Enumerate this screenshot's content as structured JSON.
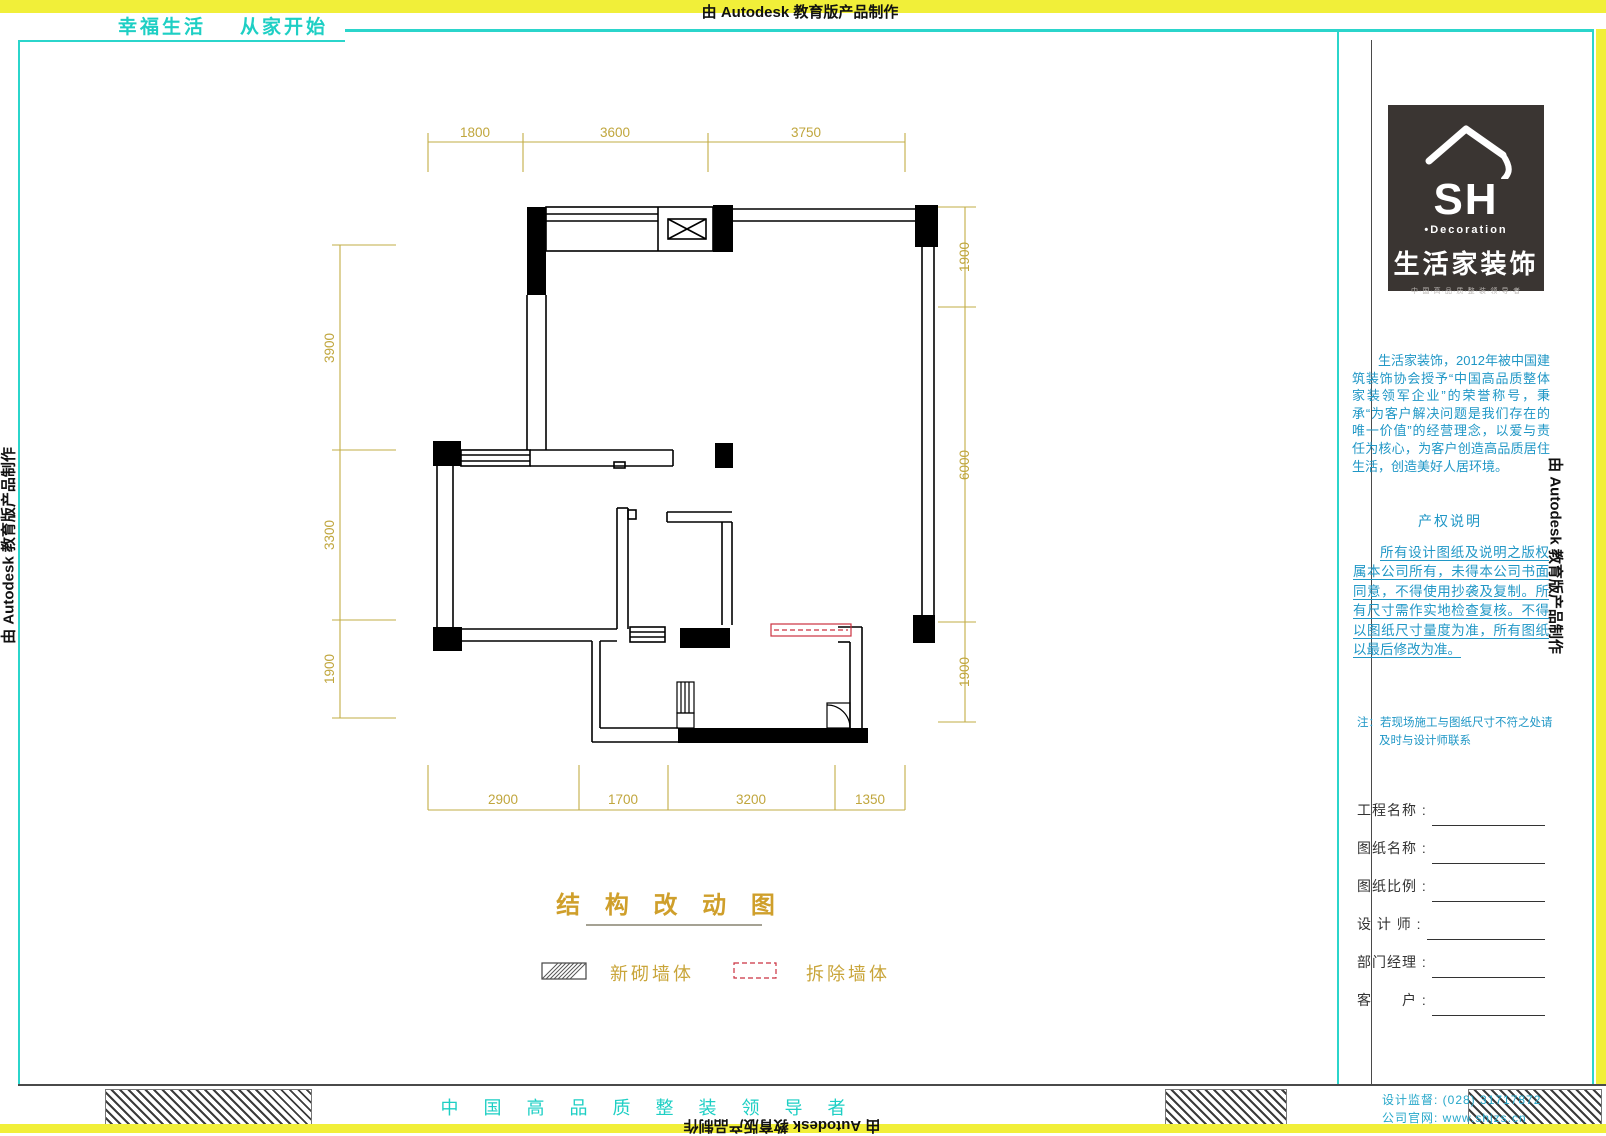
{
  "banner": {
    "autodesk": "由 Autodesk 教育版产品制作"
  },
  "header": {
    "slogan_left": "幸福生活",
    "slogan_right": "从家开始"
  },
  "logo": {
    "sh": "SH",
    "decoration": "•Decoration",
    "brand": "生活家装饰",
    "tagline": "中·国·高·品·质·整·装·领·导·者"
  },
  "sidebar": {
    "intro": "生活家装饰，2012年被中国建筑装饰协会授予“中国高品质整体家装领军企业”的荣誉称号，秉承“为客户解决问题是我们存在的唯一价值”的经营理念，以爱与责任为核心，为客户创造高品质居住生活，创造美好人居环境。",
    "copyright_title": "产权说明",
    "copyright_body": "所有设计图纸及说明之版权属本公司所有，未得本公司书面同意，不得使用抄袭及复制。所有尺寸需作实地检查复核。不得以图纸尺寸量度为准，所有图纸以最后修改为准。",
    "note_line1": "注：若现场施工与图纸尺寸不符之处请",
    "note_line2": "及时与设计师联系",
    "fields": [
      {
        "label": "工程名称 :"
      },
      {
        "label": "图纸名称 :"
      },
      {
        "label": "图纸比例 :"
      },
      {
        "label": "设 计 师 :"
      },
      {
        "label": "部门经理 :"
      },
      {
        "label": "客　　户 :"
      }
    ]
  },
  "footer": {
    "slogan": "中 国 高 品 质 整 装 领 导 者",
    "phone": "设计监督: (028) 31717872",
    "website": "公司官网: www.shjzs.cn"
  },
  "drawing": {
    "title": "结 构 改 动 图",
    "legend": [
      {
        "symbol": "hatched-wall",
        "label": "新砌墙体"
      },
      {
        "symbol": "red-dashed-wall",
        "label": "拆除墙体"
      }
    ],
    "dims": {
      "top": [
        "1800",
        "3600",
        "3750"
      ],
      "bottom": [
        "2900",
        "1700",
        "3200",
        "1350"
      ],
      "left": [
        "3900",
        "3300",
        "1900"
      ],
      "right": [
        "1900",
        "6000",
        "1900"
      ]
    }
  },
  "colors": {
    "teal": "#1ecfc4",
    "yellow_strip": "#f1ef39",
    "dimension": "#c2ac45",
    "gold_title": "#cf9f2b",
    "sidebar_blue": "#2097c6",
    "demolish_red": "#cb3140",
    "logo_bg": "#3a3532"
  }
}
